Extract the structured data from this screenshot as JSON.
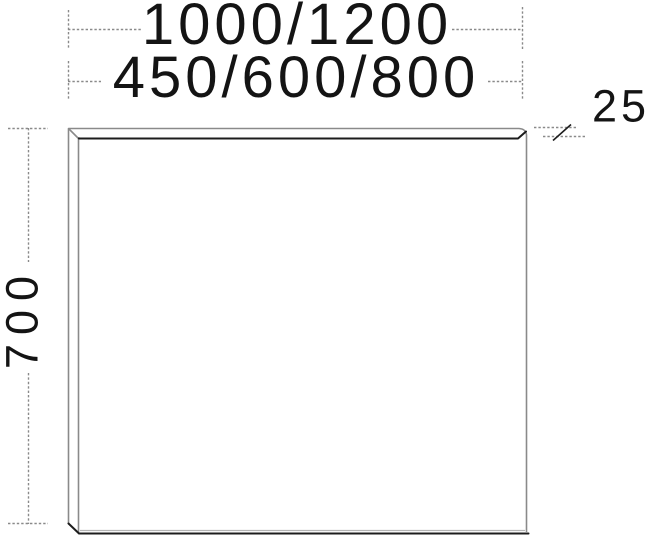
{
  "drawing": {
    "title": "panel-dimension-drawing",
    "labels": {
      "width_primary": "1000/1200",
      "width_secondary": "450/600/800",
      "height": "700",
      "depth": "25"
    },
    "colors": {
      "line_gray": "#8a8a8a",
      "line_black": "#1c1c1c",
      "line_shadow": "#b4b4b4",
      "text": "#141414",
      "background": "#ffffff"
    }
  }
}
